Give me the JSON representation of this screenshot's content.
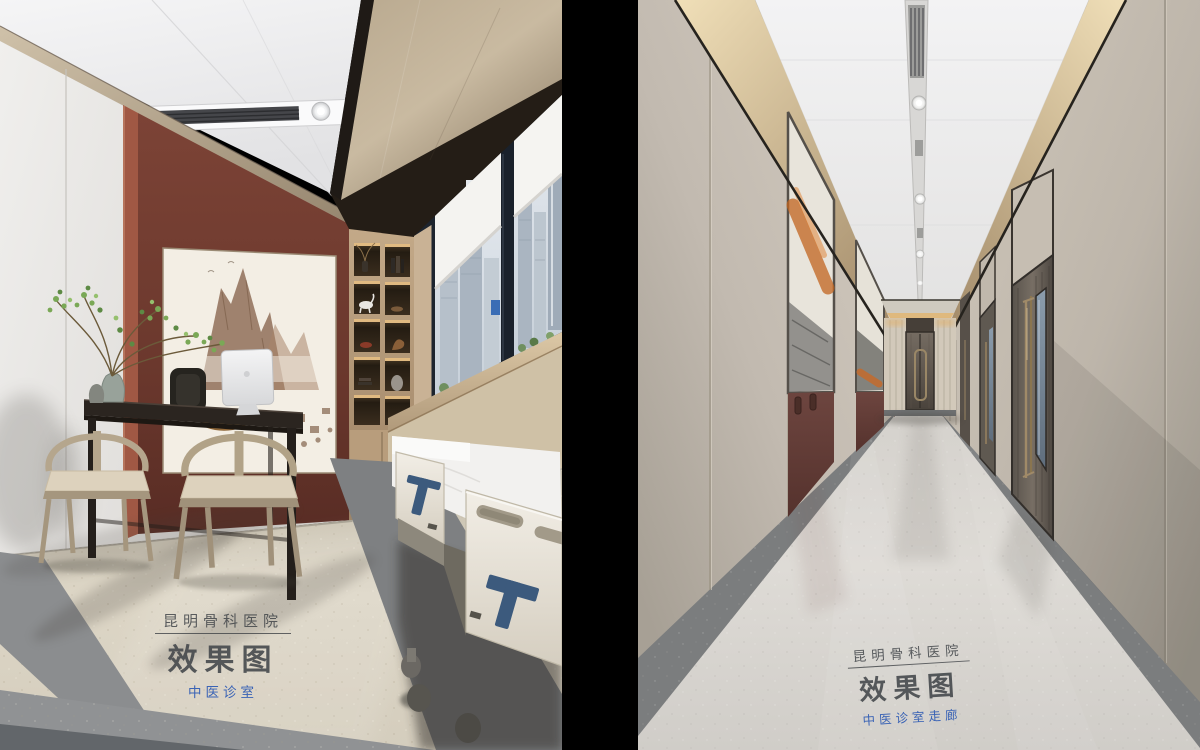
{
  "page": {
    "background": "#000000",
    "description": "Two interior design renderings of a hospital TCM clinic, side by side on black"
  },
  "left_panel": {
    "scene": "TCM consultation room rendering",
    "watermark": {
      "hospital": "昆明骨科医院",
      "label": "效果图",
      "subtitle": "中医诊室",
      "text_color": "#42464a",
      "subtitle_color": "#3a63b5"
    }
  },
  "right_panel": {
    "scene": "TCM clinic corridor rendering",
    "watermark": {
      "hospital": "昆明骨科医院",
      "label": "效果图",
      "subtitle": "中医诊室走廊",
      "text_color": "#42464a",
      "subtitle_color": "#3a63b5"
    }
  },
  "palette": {
    "ceiling_white": "#eeeef0",
    "accent_wall_maroon": "#6f3a2f",
    "wood_trim": "#b3a089",
    "corridor_wall": "#c9c1b4",
    "cove_light_gold": "#e6cfa3",
    "door_bronze": "#655d55",
    "floor_center_beige": "#d9d4c9",
    "floor_border_gray": "#7b7d7e",
    "bed_accent_blue": "#3c5a7d",
    "plant_green": "#7aa856",
    "art_orange": "#c2641f",
    "window_frame": "#1d242e"
  }
}
